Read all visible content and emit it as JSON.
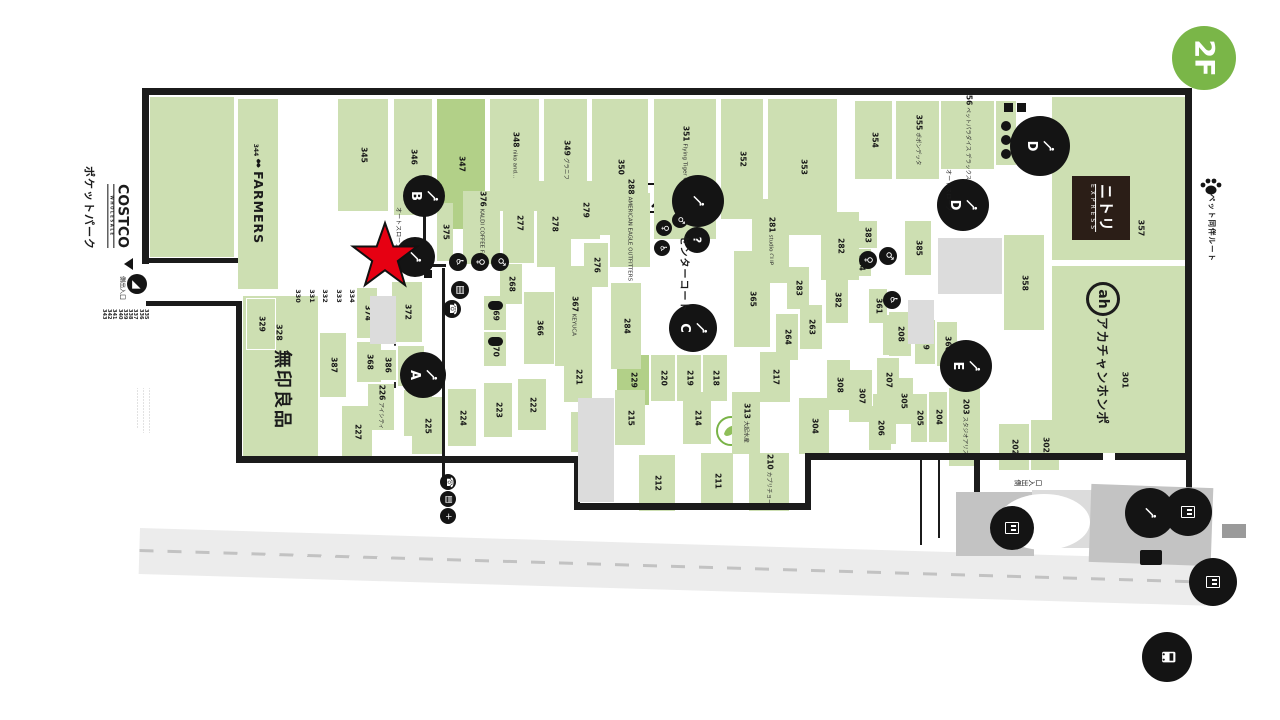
{
  "floor_badge": {
    "label": "2F",
    "color": "#7ab648"
  },
  "left_panel": {
    "pocket_park": "ポケットパーク",
    "costco": "COSTCO",
    "costco_sub": "WHOLESALE",
    "entrance_label": "側出入口",
    "service_numbers": [
      "335",
      "336",
      "337",
      "338",
      "339",
      "340",
      "341",
      "342",
      "343"
    ],
    "fine_print_lines": [
      "…………………………",
      "…………………………",
      "………………………"
    ]
  },
  "anchors": {
    "farmers_num": "344",
    "farmers_name": "FARMERS",
    "muji_num": "328",
    "muji_name": "無印良品",
    "nitori_num": "357",
    "nitori_name": "ニトリ",
    "nitori_sub": "EXPRESS",
    "akachan_num": "301",
    "akachan_logo": "ah",
    "akachan_name": "アカチャンホンポ"
  },
  "map": {
    "palette": {
      "green": "#cddfb2",
      "green_dark": "#b2d088",
      "black": "#1b1b1b",
      "gray": "#dcdcdc",
      "road": "#ececec",
      "red_star": "#e60012"
    },
    "stores": [
      {
        "n": "345",
        "t": "",
        "x": 338,
        "y": 99,
        "w": 50,
        "h": 112
      },
      {
        "n": "346",
        "t": "",
        "x": 394,
        "y": 99,
        "w": 38,
        "h": 116
      },
      {
        "n": "347",
        "t": "",
        "x": 437,
        "y": 99,
        "w": 48,
        "h": 130,
        "d": 1
      },
      {
        "n": "348",
        "t": "niko and...",
        "x": 490,
        "y": 99,
        "w": 49,
        "h": 112
      },
      {
        "n": "349",
        "t": "グラニフ",
        "x": 544,
        "y": 99,
        "w": 43,
        "h": 122
      },
      {
        "n": "350",
        "t": "",
        "x": 592,
        "y": 99,
        "w": 56,
        "h": 136
      },
      {
        "n": "351",
        "t": "Flying Tiger Copenhagen",
        "x": 654,
        "y": 99,
        "w": 62,
        "h": 140
      },
      {
        "n": "352",
        "t": "",
        "x": 721,
        "y": 99,
        "w": 42,
        "h": 120
      },
      {
        "n": "353",
        "t": "",
        "x": 768,
        "y": 99,
        "w": 69,
        "h": 136
      },
      {
        "n": "354",
        "t": "",
        "x": 855,
        "y": 101,
        "w": 37,
        "h": 78
      },
      {
        "n": "355",
        "t": "ポポンデッタ",
        "x": 896,
        "y": 101,
        "w": 43,
        "h": 78
      },
      {
        "n": "356",
        "t": "ペットパラダイス デラックス",
        "x": 941,
        "y": 101,
        "w": 53,
        "h": 68
      },
      {
        "n": "",
        "t": "",
        "x": 996,
        "y": 101,
        "w": 20,
        "h": 64
      },
      {
        "n": "376",
        "t": "KALDI COFFEE FARM",
        "x": 463,
        "y": 191,
        "w": 37,
        "h": 73
      },
      {
        "n": "277",
        "t": "",
        "x": 503,
        "y": 183,
        "w": 31,
        "h": 80
      },
      {
        "n": "278",
        "t": "",
        "x": 537,
        "y": 181,
        "w": 34,
        "h": 86
      },
      {
        "n": "279",
        "t": "",
        "x": 570,
        "y": 181,
        "w": 30,
        "h": 58
      },
      {
        "n": "276",
        "t": "",
        "x": 584,
        "y": 243,
        "w": 24,
        "h": 44
      },
      {
        "n": "288",
        "t": "AMERICAN EAGLE OUTFITTERS",
        "x": 610,
        "y": 193,
        "w": 40,
        "h": 74
      },
      {
        "n": "268",
        "t": "",
        "x": 500,
        "y": 264,
        "w": 22,
        "h": 40
      },
      {
        "n": "366",
        "t": "",
        "x": 524,
        "y": 292,
        "w": 30,
        "h": 72
      },
      {
        "n": "367",
        "t": "KEYUCA",
        "x": 555,
        "y": 266,
        "w": 37,
        "h": 100
      },
      {
        "n": "369",
        "t": "",
        "x": 484,
        "y": 296,
        "w": 22,
        "h": 34
      },
      {
        "n": "370",
        "t": "",
        "x": 484,
        "y": 332,
        "w": 22,
        "h": 34
      },
      {
        "n": "375",
        "t": "",
        "x": 437,
        "y": 203,
        "w": 16,
        "h": 58
      },
      {
        "n": "372",
        "t": "",
        "x": 392,
        "y": 282,
        "w": 30,
        "h": 60
      },
      {
        "n": "373",
        "t": "",
        "x": 398,
        "y": 346,
        "w": 26,
        "h": 40
      },
      {
        "n": "371",
        "t": "",
        "x": 404,
        "y": 390,
        "w": 28,
        "h": 46
      },
      {
        "n": "374",
        "t": "",
        "x": 357,
        "y": 288,
        "w": 20,
        "h": 50
      },
      {
        "n": "368",
        "t": "",
        "x": 357,
        "y": 342,
        "w": 24,
        "h": 40
      },
      {
        "n": "386",
        "t": "",
        "x": 378,
        "y": 350,
        "w": 18,
        "h": 30
      },
      {
        "n": "387",
        "t": "",
        "x": 320,
        "y": 333,
        "w": 26,
        "h": 64
      },
      {
        "n": "226",
        "t": "アイシティ",
        "x": 368,
        "y": 384,
        "w": 26,
        "h": 46
      },
      {
        "n": "227",
        "t": "",
        "x": 342,
        "y": 406,
        "w": 30,
        "h": 52
      },
      {
        "n": "225",
        "t": "",
        "x": 412,
        "y": 397,
        "w": 30,
        "h": 57
      },
      {
        "n": "224",
        "t": "",
        "x": 448,
        "y": 389,
        "w": 28,
        "h": 57
      },
      {
        "n": "223",
        "t": "",
        "x": 484,
        "y": 383,
        "w": 28,
        "h": 54
      },
      {
        "n": "222",
        "t": "",
        "x": 518,
        "y": 379,
        "w": 28,
        "h": 51
      },
      {
        "n": "329",
        "t": "",
        "x": 246,
        "y": 298,
        "w": 28,
        "h": 50,
        "o": 1
      },
      {
        "n": "221",
        "t": "",
        "x": 564,
        "y": 352,
        "w": 28,
        "h": 50
      },
      {
        "n": "229",
        "t": "",
        "x": 617,
        "y": 355,
        "w": 32,
        "h": 50,
        "d": 1
      },
      {
        "n": "220",
        "t": "",
        "x": 651,
        "y": 355,
        "w": 24,
        "h": 46
      },
      {
        "n": "219",
        "t": "",
        "x": 677,
        "y": 355,
        "w": 24,
        "h": 46
      },
      {
        "n": "218",
        "t": "",
        "x": 703,
        "y": 355,
        "w": 24,
        "h": 46
      },
      {
        "n": "217",
        "t": "",
        "x": 760,
        "y": 352,
        "w": 30,
        "h": 50
      },
      {
        "n": "216",
        "t": "",
        "x": 571,
        "y": 412,
        "w": 22,
        "h": 40
      },
      {
        "n": "215",
        "t": "",
        "x": 615,
        "y": 390,
        "w": 30,
        "h": 55
      },
      {
        "n": "214",
        "t": "",
        "x": 683,
        "y": 392,
        "w": 28,
        "h": 52
      },
      {
        "n": "313",
        "t": "大起水産",
        "x": 732,
        "y": 392,
        "w": 28,
        "h": 62
      },
      {
        "n": "212",
        "t": "",
        "x": 639,
        "y": 455,
        "w": 36,
        "h": 56
      },
      {
        "n": "211",
        "t": "",
        "x": 701,
        "y": 453,
        "w": 32,
        "h": 56
      },
      {
        "n": "210",
        "t": "カプリチョーザ",
        "x": 749,
        "y": 453,
        "w": 40,
        "h": 58
      },
      {
        "n": "304",
        "t": "",
        "x": 799,
        "y": 398,
        "w": 30,
        "h": 56
      },
      {
        "n": "305",
        "t": "",
        "x": 893,
        "y": 378,
        "w": 20,
        "h": 46
      },
      {
        "n": "306",
        "t": "",
        "x": 873,
        "y": 394,
        "w": 23,
        "h": 50
      },
      {
        "n": "307",
        "t": "",
        "x": 849,
        "y": 370,
        "w": 23,
        "h": 52
      },
      {
        "n": "308",
        "t": "",
        "x": 827,
        "y": 360,
        "w": 23,
        "h": 50
      },
      {
        "n": "281",
        "t": "studio CLIP",
        "x": 752,
        "y": 199,
        "w": 37,
        "h": 84
      },
      {
        "n": "365",
        "t": "",
        "x": 734,
        "y": 251,
        "w": 36,
        "h": 96
      },
      {
        "n": "284",
        "t": "",
        "x": 611,
        "y": 283,
        "w": 30,
        "h": 86
      },
      {
        "n": "282",
        "t": "",
        "x": 821,
        "y": 212,
        "w": 38,
        "h": 68
      },
      {
        "n": "283",
        "t": "",
        "x": 787,
        "y": 267,
        "w": 22,
        "h": 42
      },
      {
        "n": "264",
        "t": "",
        "x": 776,
        "y": 314,
        "w": 22,
        "h": 46
      },
      {
        "n": "263",
        "t": "",
        "x": 800,
        "y": 305,
        "w": 22,
        "h": 44
      },
      {
        "n": "382",
        "t": "",
        "x": 826,
        "y": 277,
        "w": 22,
        "h": 46
      },
      {
        "n": "383",
        "t": "",
        "x": 857,
        "y": 221,
        "w": 20,
        "h": 27
      },
      {
        "n": "384",
        "t": "",
        "x": 851,
        "y": 249,
        "w": 20,
        "h": 27
      },
      {
        "n": "385",
        "t": "",
        "x": 905,
        "y": 221,
        "w": 26,
        "h": 54
      },
      {
        "n": "381",
        "t": "",
        "x": 883,
        "y": 315,
        "w": 20,
        "h": 40
      },
      {
        "n": "359",
        "t": "",
        "x": 915,
        "y": 320,
        "w": 20,
        "h": 44
      },
      {
        "n": "360",
        "t": "",
        "x": 937,
        "y": 322,
        "w": 20,
        "h": 44
      },
      {
        "n": "361",
        "t": "",
        "x": 869,
        "y": 289,
        "w": 18,
        "h": 34
      },
      {
        "n": "208",
        "t": "",
        "x": 889,
        "y": 312,
        "w": 22,
        "h": 44
      },
      {
        "n": "207",
        "t": "",
        "x": 877,
        "y": 358,
        "w": 22,
        "h": 44
      },
      {
        "n": "206",
        "t": "",
        "x": 869,
        "y": 406,
        "w": 22,
        "h": 44
      },
      {
        "n": "205",
        "t": "",
        "x": 911,
        "y": 394,
        "w": 16,
        "h": 48
      },
      {
        "n": "204",
        "t": "",
        "x": 929,
        "y": 392,
        "w": 18,
        "h": 50
      },
      {
        "n": "203",
        "t": "スタジオアリス",
        "x": 949,
        "y": 388,
        "w": 31,
        "h": 78
      },
      {
        "n": "202",
        "t": "",
        "x": 999,
        "y": 424,
        "w": 30,
        "h": 46
      },
      {
        "n": "302",
        "t": "",
        "x": 1031,
        "y": 420,
        "w": 28,
        "h": 50
      },
      {
        "n": "358",
        "t": "",
        "x": 1004,
        "y": 235,
        "w": 40,
        "h": 95
      }
    ],
    "numstrips": {
      "x0": 292,
      "step": 13.5,
      "y": 216,
      "h": 86,
      "nums": [
        "330",
        "331",
        "332",
        "333",
        "334"
      ]
    },
    "walls": [
      [
        142,
        88,
        1050,
        7
      ],
      [
        1185,
        95,
        7,
        365
      ],
      [
        805,
        453,
        387,
        7
      ],
      [
        805,
        453,
        6,
        57
      ],
      [
        574,
        503,
        237,
        7
      ],
      [
        574,
        456,
        6,
        54
      ],
      [
        236,
        456,
        344,
        7
      ],
      [
        236,
        306,
        6,
        157
      ],
      [
        142,
        88,
        7,
        176
      ],
      [
        146,
        258,
        92,
        5
      ],
      [
        146,
        301,
        96,
        5
      ],
      [
        974,
        460,
        6,
        44
      ],
      [
        974,
        498,
        218,
        6
      ],
      [
        1186,
        460,
        6,
        44
      ],
      [
        442,
        268,
        3,
        210
      ],
      [
        423,
        216,
        3,
        26
      ],
      [
        416,
        264,
        30,
        3
      ],
      [
        920,
        460,
        2,
        85
      ],
      [
        938,
        460,
        2,
        78
      ],
      [
        1103,
        453,
        12,
        7,
        "#ffffff"
      ]
    ],
    "grays": [
      [
        938,
        238,
        64,
        56
      ],
      [
        908,
        300,
        26,
        44
      ],
      [
        370,
        296,
        26,
        48
      ],
      [
        578,
        398,
        36,
        104
      ]
    ],
    "plaza": [
      [
        956,
        492,
        78,
        64,
        "#c3c3c3",
        0
      ],
      [
        1032,
        490,
        62,
        58,
        "#dcdcdc",
        0
      ],
      [
        1090,
        486,
        122,
        78,
        "#c3c3c3",
        2
      ],
      [
        998,
        494,
        92,
        56,
        "#ffffff",
        0,
        1
      ],
      [
        1222,
        524,
        24,
        14,
        "#9a9a9a",
        0
      ]
    ],
    "badges": [
      {
        "l": "B",
        "x": 424,
        "y": 196,
        "r": 21,
        "name": "escalator-b-badge"
      },
      {
        "l": "",
        "x": 415,
        "y": 257,
        "r": 20,
        "name": "escalator-badge"
      },
      {
        "l": "A",
        "x": 423,
        "y": 375,
        "r": 23,
        "name": "escalator-a-badge"
      },
      {
        "l": "",
        "x": 698,
        "y": 201,
        "r": 26,
        "name": "escalator-up-badge"
      },
      {
        "l": "C",
        "x": 693,
        "y": 328,
        "r": 24,
        "name": "escalator-c-badge"
      },
      {
        "l": "D",
        "x": 963,
        "y": 205,
        "r": 26,
        "name": "escalator-d-badge"
      },
      {
        "l": "D",
        "x": 1040,
        "y": 146,
        "r": 30,
        "name": "escalator-d2-badge"
      },
      {
        "l": "E",
        "x": 966,
        "y": 366,
        "r": 26,
        "name": "escalator-e-badge"
      },
      {
        "l": "",
        "x": 1150,
        "y": 513,
        "r": 25,
        "name": "escalator-south-badge"
      },
      {
        "l": "",
        "x": 1188,
        "y": 512,
        "r": 24,
        "type": "elev",
        "name": "elevator-icon"
      },
      {
        "l": "",
        "x": 1213,
        "y": 582,
        "r": 24,
        "type": "elev",
        "name": "elevator-icon"
      },
      {
        "l": "",
        "x": 1012,
        "y": 528,
        "r": 22,
        "type": "elev",
        "name": "elevator-icon"
      },
      {
        "l": "",
        "x": 1167,
        "y": 657,
        "r": 25,
        "type": "bus",
        "name": "bus-stop-icon"
      },
      {
        "l": "?",
        "x": 697,
        "y": 240,
        "r": 13,
        "type": "info",
        "name": "information-icon"
      }
    ],
    "icons": [
      {
        "g": "♿",
        "x": 458,
        "y": 262,
        "r": 9,
        "name": "accessible-toilet-icon"
      },
      {
        "g": "♀",
        "x": 480,
        "y": 262,
        "r": 9,
        "name": "womens-toilet-icon"
      },
      {
        "g": "♂",
        "x": 500,
        "y": 262,
        "r": 9,
        "name": "mens-toilet-icon"
      },
      {
        "g": "▤",
        "x": 460,
        "y": 290,
        "r": 9,
        "name": "coin-locker-icon"
      },
      {
        "g": "☎",
        "x": 452,
        "y": 309,
        "r": 9,
        "name": "phone-icon"
      },
      {
        "g": "♀",
        "x": 664,
        "y": 228,
        "r": 8,
        "name": "womens-toilet-icon"
      },
      {
        "g": "♂",
        "x": 680,
        "y": 220,
        "r": 8,
        "name": "mens-toilet-icon"
      },
      {
        "g": "♿",
        "x": 662,
        "y": 248,
        "r": 8,
        "name": "accessible-toilet-icon"
      },
      {
        "g": "♀",
        "x": 868,
        "y": 260,
        "r": 9,
        "name": "womens-toilet-icon"
      },
      {
        "g": "♂",
        "x": 888,
        "y": 256,
        "r": 9,
        "name": "mens-toilet-icon"
      },
      {
        "g": "♿",
        "x": 892,
        "y": 300,
        "r": 9,
        "name": "accessible-toilet-icon"
      },
      {
        "g": "☎",
        "x": 448,
        "y": 482,
        "r": 8,
        "name": "phone-icon"
      },
      {
        "g": "▤",
        "x": 448,
        "y": 499,
        "r": 8,
        "name": "coin-locker-icon"
      },
      {
        "g": "+",
        "x": 448,
        "y": 516,
        "r": 8,
        "name": "aed-icon"
      },
      {
        "g": "◢",
        "x": 137,
        "y": 284,
        "r": 10,
        "name": "slope-entrance-icon"
      },
      {
        "g": "",
        "x": 1006,
        "y": 126,
        "r": 5,
        "name": "toilet-icon"
      },
      {
        "g": "",
        "x": 1006,
        "y": 140,
        "r": 5,
        "name": "toilet-icon"
      },
      {
        "g": "",
        "x": 1006,
        "y": 154,
        "r": 5,
        "name": "toilet-icon"
      }
    ],
    "rects": [
      [
        488,
        301,
        15,
        9,
        "#141414",
        5
      ],
      [
        488,
        337,
        15,
        9,
        "#141414",
        5
      ],
      [
        424,
        250,
        8,
        8,
        "#141414",
        0
      ],
      [
        424,
        260,
        8,
        8,
        "#141414",
        0
      ],
      [
        424,
        270,
        8,
        8,
        "#141414",
        0
      ],
      [
        1004,
        103,
        9,
        9,
        "#141414",
        0
      ],
      [
        1017,
        103,
        9,
        9,
        "#141414",
        0
      ],
      [
        1140,
        550,
        22,
        15,
        "#141414",
        2
      ]
    ],
    "labels": [
      {
        "t": "センターコート",
        "x": 676,
        "y": 244,
        "c": "cc",
        "n": "center-court-label"
      },
      {
        "t": "オートスロープ",
        "x": 390,
        "y": 198,
        "c": "sm",
        "n": "auto-slope-label"
      },
      {
        "t": "オートスロープ",
        "x": 940,
        "y": 160,
        "c": "sm",
        "n": "auto-slope-label"
      },
      {
        "t": "ペット同伴ルート",
        "x": 1204,
        "y": 198,
        "c": "pet",
        "n": "pet-route-label"
      },
      {
        "t": "側出入口",
        "x": 114,
        "y": 258,
        "c": "sm",
        "n": "costco-entrance-label"
      },
      {
        "t": "側出入口",
        "x": 1014,
        "y": 470,
        "c": "crot",
        "n": "south-entrance-label"
      },
      {
        "t": "357",
        "x": 1134,
        "y": 198,
        "c": "num",
        "n": "store-number-357"
      },
      {
        "t": "301",
        "x": 1118,
        "y": 350,
        "c": "num",
        "n": "store-number-301"
      }
    ]
  }
}
